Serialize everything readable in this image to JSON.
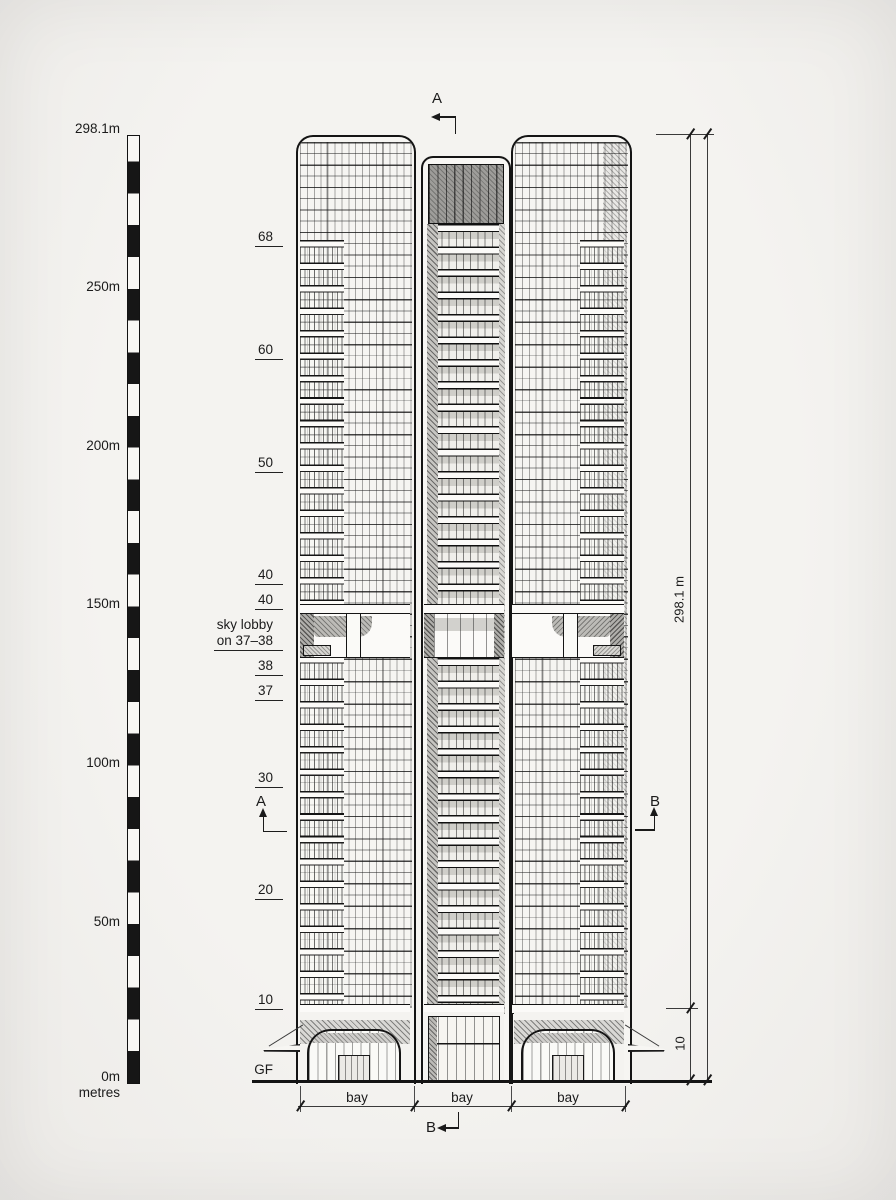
{
  "scale": {
    "labels": [
      "298.1m",
      "250m",
      "200m",
      "150m",
      "100m",
      "50m",
      "0m"
    ],
    "unit": "metres"
  },
  "floors": [
    {
      "text": "68"
    },
    {
      "text": "60"
    },
    {
      "text": "50"
    },
    {
      "text": "40"
    },
    {
      "text": "40"
    },
    {
      "text": "sky lobby",
      "text2": "on 37–38"
    },
    {
      "text": "38"
    },
    {
      "text": "37"
    },
    {
      "text": "30"
    },
    {
      "text": "20"
    },
    {
      "text": "10"
    },
    {
      "text": "GF"
    }
  ],
  "markers": {
    "top": "A",
    "left": "A",
    "right": "B",
    "bottom": "B"
  },
  "dims": {
    "total_height": "298.1 m",
    "podium": "10",
    "bays": [
      "bay",
      "bay",
      "bay"
    ]
  },
  "colors": {
    "ink": "#1a1a1a",
    "paper": "#f1f0ee",
    "hatch_gray": "#9e9d9a"
  }
}
